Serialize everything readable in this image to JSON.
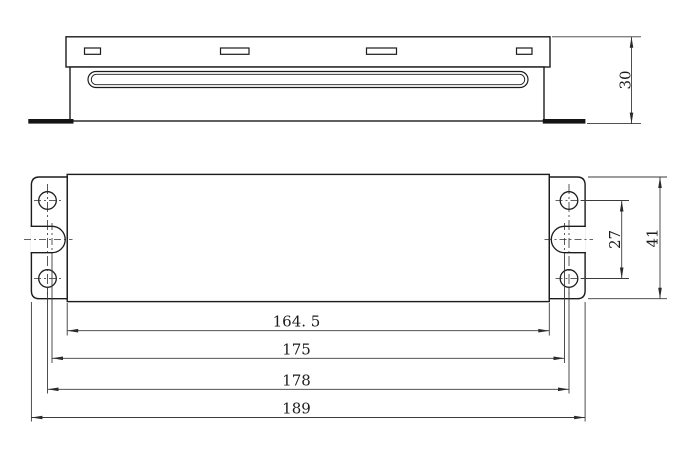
{
  "colors": {
    "background": "#ffffff",
    "outline": "#1c1c1c",
    "dimension_line": "#3a3a3a",
    "text": "#1c1c1c"
  },
  "dimensions": {
    "plan_horizontal": [
      {
        "id": "body-length",
        "label": "164. 5",
        "value": 164.5
      },
      {
        "id": "slot-center-spacing",
        "label": "175",
        "value": 175
      },
      {
        "id": "hole-center-spacing",
        "label": "178",
        "value": 178
      },
      {
        "id": "overall-length",
        "label": "189",
        "value": 189
      }
    ],
    "plan_vertical": [
      {
        "id": "hole-row-spacing",
        "label": "27",
        "value": 27
      },
      {
        "id": "body-width",
        "label": "41",
        "value": 41
      }
    ],
    "side_vertical": [
      {
        "id": "overall-height",
        "label": "30",
        "value": 30
      }
    ]
  }
}
